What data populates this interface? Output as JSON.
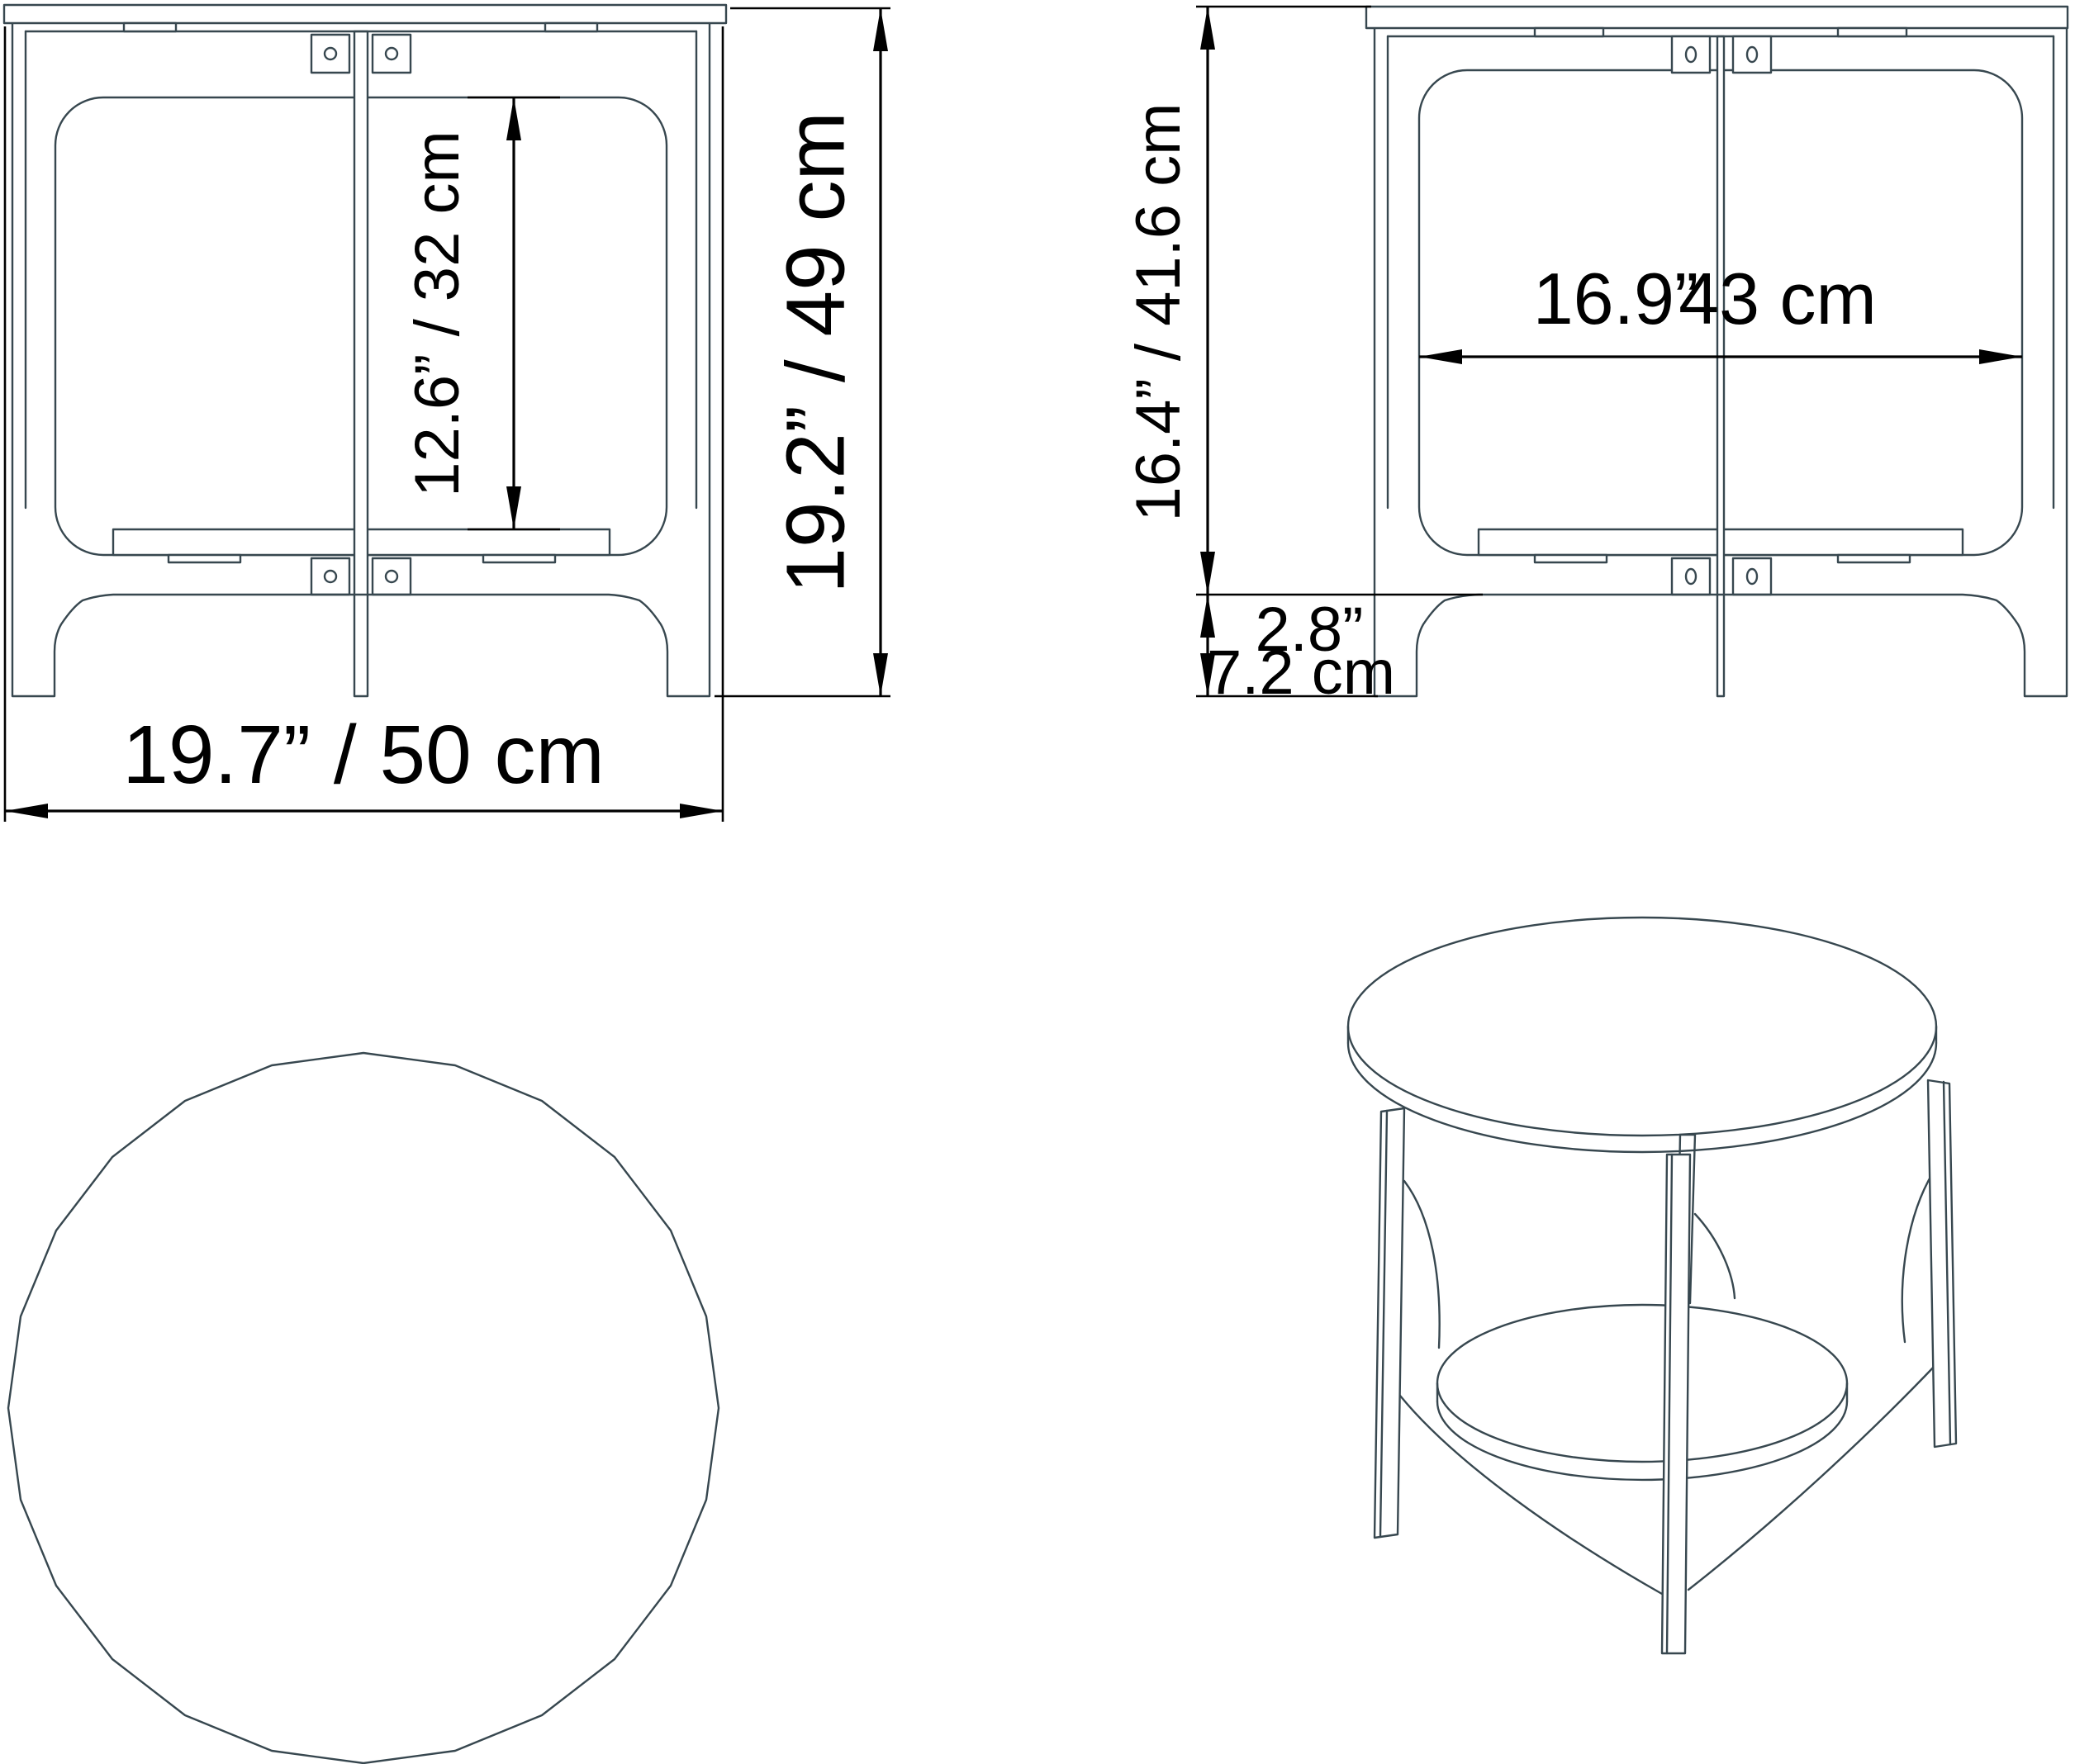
{
  "title": "Round side table technical dimension drawing",
  "colors": {
    "line": "#37474f",
    "dimension": "#000000",
    "background": "#ffffff"
  },
  "labels": {
    "front_width": "19.7” / 50 cm",
    "front_height": "19.2” / 49 cm",
    "front_shelf_clearance": "12.6” / 32 cm",
    "side_upper_height": "16.4” / 41.6 cm",
    "side_inner_width_in": "16.9”",
    "side_inner_width_cm": "43 cm",
    "side_foot_height_in": "2.8”",
    "side_foot_height_cm": "7.2 cm"
  },
  "views": {
    "front": "front elevation",
    "side": "side elevation",
    "top": "top plan view",
    "perspective": "3d perspective view"
  }
}
